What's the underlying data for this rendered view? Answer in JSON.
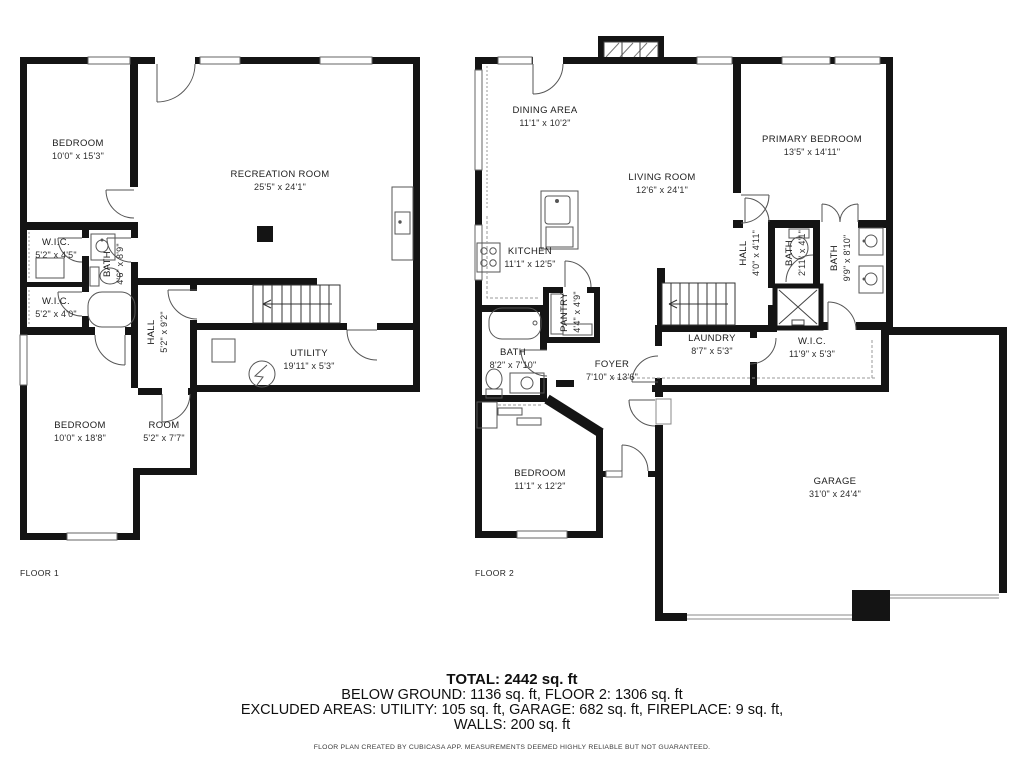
{
  "title": "Floor plan",
  "colors": {
    "wall": "#141414",
    "thin_line": "#555555",
    "dashed_line": "#999999",
    "text": "#1c1c1c"
  },
  "floors": [
    {
      "label": "FLOOR 1",
      "rooms": [
        {
          "name": "BEDROOM",
          "dims": "10'0\" x 15'3\"",
          "x": 78,
          "y": 150,
          "rotate": false
        },
        {
          "name": "RECREATION ROOM",
          "dims": "25'5\" x 24'1\"",
          "x": 280,
          "y": 181,
          "rotate": false
        },
        {
          "name": "W.I.C.",
          "dims": "5'2\" x 4'5\"",
          "x": 56,
          "y": 249,
          "rotate": false
        },
        {
          "name": "BATH",
          "dims": "4'6\" x 8'9\"",
          "x": 114,
          "y": 264,
          "rotate": true
        },
        {
          "name": "W.I.C.",
          "dims": "5'2\" x 4'0\"",
          "x": 56,
          "y": 308,
          "rotate": false
        },
        {
          "name": "HALL",
          "dims": "5'2\" x 9'2\"",
          "x": 158,
          "y": 332,
          "rotate": true
        },
        {
          "name": "UTILITY",
          "dims": "19'11\" x 5'3\"",
          "x": 309,
          "y": 360,
          "rotate": false
        },
        {
          "name": "BEDROOM",
          "dims": "10'0\" x 18'8\"",
          "x": 80,
          "y": 432,
          "rotate": false
        },
        {
          "name": "ROOM",
          "dims": "5'2\" x 7'7\"",
          "x": 164,
          "y": 432,
          "rotate": false
        }
      ]
    },
    {
      "label": "FLOOR 2",
      "rooms": [
        {
          "name": "DINING AREA",
          "dims": "11'1\" x 10'2\"",
          "x": 545,
          "y": 117,
          "rotate": false
        },
        {
          "name": "LIVING ROOM",
          "dims": "12'6\" x 24'1\"",
          "x": 662,
          "y": 184,
          "rotate": false
        },
        {
          "name": "PRIMARY BEDROOM",
          "dims": "13'5\" x 14'11\"",
          "x": 812,
          "y": 146,
          "rotate": false
        },
        {
          "name": "KITCHEN",
          "dims": "11'1\" x 12'5\"",
          "x": 530,
          "y": 258,
          "rotate": false
        },
        {
          "name": "PANTRY",
          "dims": "4'4\" x 4'9\"",
          "x": 571,
          "y": 312,
          "rotate": true
        },
        {
          "name": "HALL",
          "dims": "4'0\" x 4'11\"",
          "x": 750,
          "y": 253,
          "rotate": true
        },
        {
          "name": "BATH",
          "dims": "2'11\" x 4'1\"",
          "x": 796,
          "y": 253,
          "rotate": true
        },
        {
          "name": "BATH",
          "dims": "9'9\" x 8'10\"",
          "x": 841,
          "y": 258,
          "rotate": true
        },
        {
          "name": "BATH",
          "dims": "8'2\" x 7'10\"",
          "x": 513,
          "y": 359,
          "rotate": false
        },
        {
          "name": "FOYER",
          "dims": "7'10\" x 13'6\"",
          "x": 612,
          "y": 371,
          "rotate": false
        },
        {
          "name": "LAUNDRY",
          "dims": "8'7\" x 5'3\"",
          "x": 712,
          "y": 345,
          "rotate": false
        },
        {
          "name": "W.I.C.",
          "dims": "11'9\" x 5'3\"",
          "x": 812,
          "y": 348,
          "rotate": false
        },
        {
          "name": "BEDROOM",
          "dims": "11'1\" x 12'2\"",
          "x": 540,
          "y": 480,
          "rotate": false
        },
        {
          "name": "GARAGE",
          "dims": "31'0\" x 24'4\"",
          "x": 835,
          "y": 488,
          "rotate": false
        }
      ]
    }
  ],
  "footer": {
    "total": "TOTAL: 2442 sq. ft",
    "line2": "BELOW GROUND: 1136 sq. ft, FLOOR 2: 1306 sq. ft",
    "line3": "EXCLUDED AREAS: UTILITY: 105 sq. ft, GARAGE: 682 sq. ft, FIREPLACE: 9 sq. ft,",
    "line4": "WALLS: 200 sq. ft",
    "disclaimer": "FLOOR PLAN CREATED BY CUBICASA APP. MEASUREMENTS DEEMED HIGHLY RELIABLE BUT NOT GUARANTEED."
  }
}
